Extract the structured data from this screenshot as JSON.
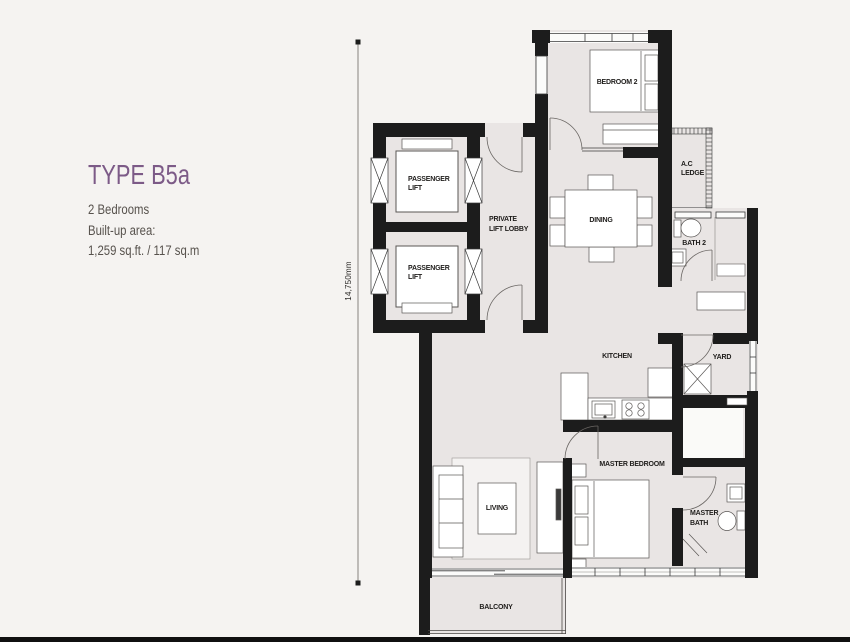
{
  "panel": {
    "type_title": "TYPE B5a",
    "bedrooms": "2 Bedrooms",
    "builtup_label": "Built-up area:",
    "builtup_value": "1,259 sq.ft. / 117 sq.m"
  },
  "dimension_label": "14,750mm",
  "labels": {
    "bedroom2": "BEDROOM 2",
    "ac_ledge": [
      "A.C",
      "LEDGE"
    ],
    "passenger_lift": [
      "PASSENGER",
      "LIFT"
    ],
    "private_lift_lobby": [
      "PRIVATE",
      "LIFT LOBBY"
    ],
    "dining": "DINING",
    "bath2": "BATH 2",
    "kitchen": "KITCHEN",
    "yard": "YARD",
    "master_bedroom": "MASTER BEDROOM",
    "living": "LIVING",
    "master_bath": [
      "MASTER",
      "BATH"
    ],
    "balcony": "BALCONY"
  },
  "colors": {
    "accent_purple": "#7c5a87",
    "wall_black": "#1c1c1c",
    "floor_gray": "#e9e5e4",
    "background": "#f5f3f1",
    "text_gray": "#57524d"
  }
}
